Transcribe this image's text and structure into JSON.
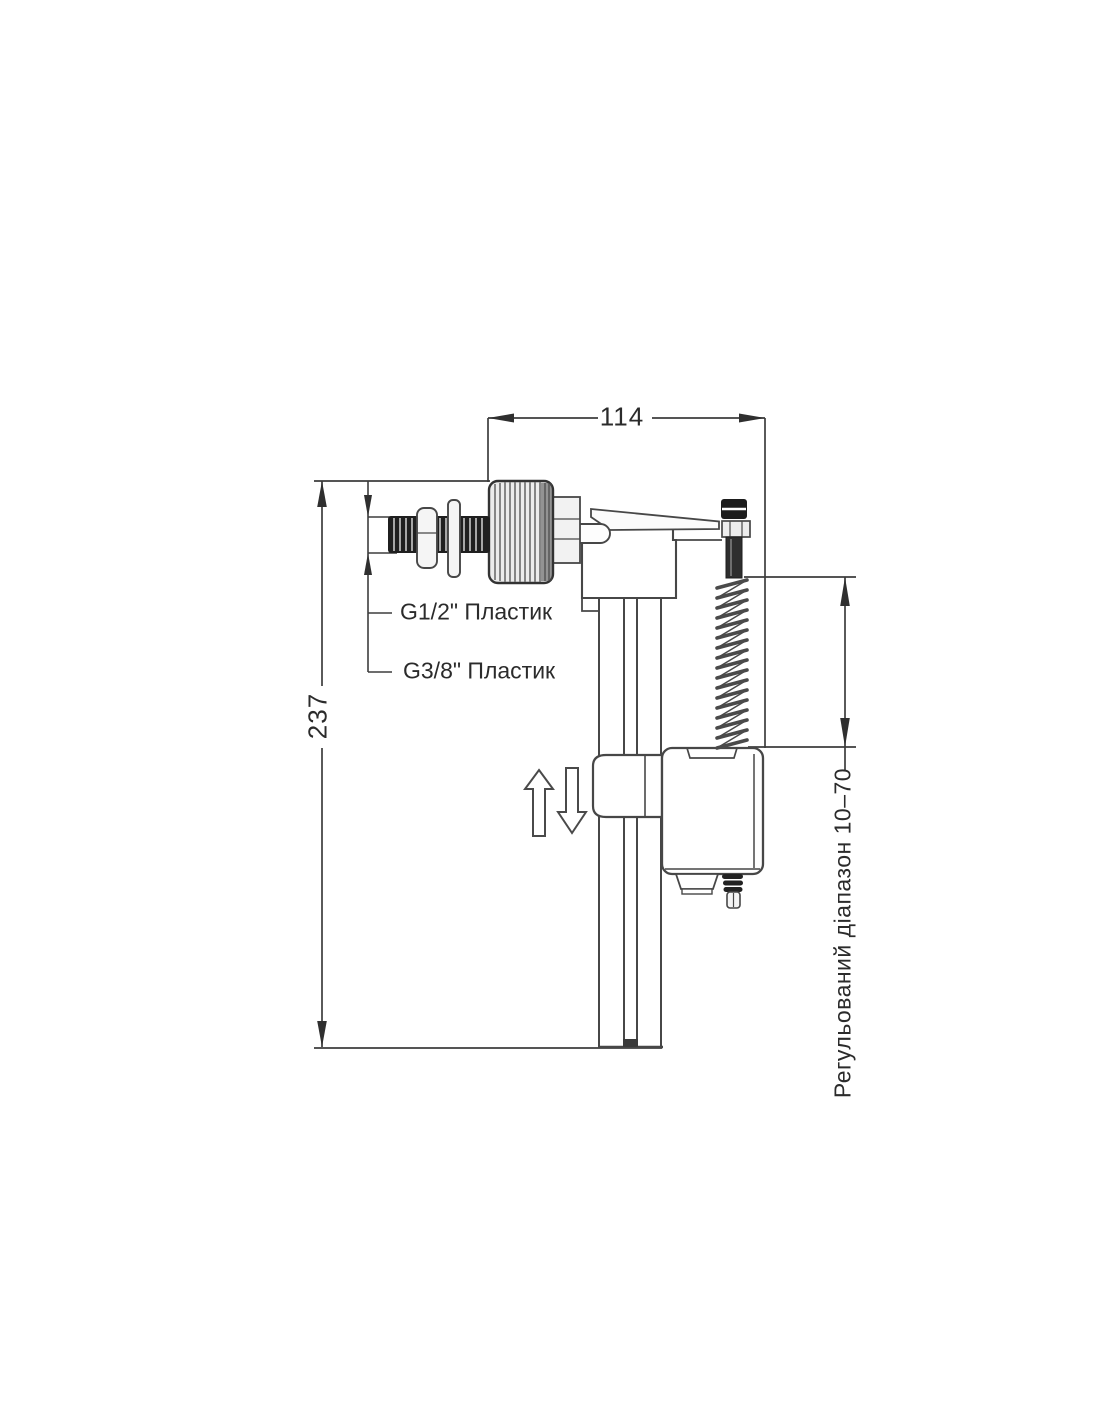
{
  "diagram": {
    "dimensions": {
      "width": "114",
      "height": "237",
      "adjustable_range": "Регульований діапазон 10–70"
    },
    "thread_labels": [
      {
        "label": "G1/2\" Пластик"
      },
      {
        "label": "G3/8\" Пластик"
      }
    ],
    "colors": {
      "line": "#3d3d3d",
      "dark_fill": "#1f1f1f",
      "light_fill": "#ededed",
      "background": "#ffffff"
    }
  }
}
